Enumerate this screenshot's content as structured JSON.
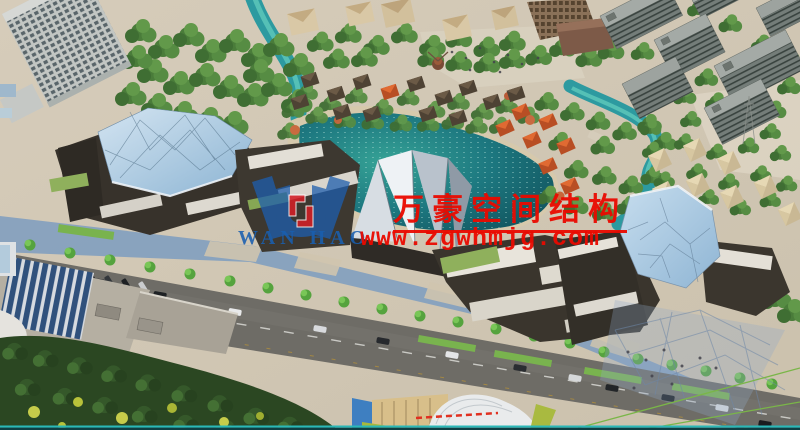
{
  "watermark": {
    "logo_text": "WAN HAO",
    "company_name_cn": "万豪空间结构",
    "website_url": "www.zgwhmjg.com",
    "brand_blue": "#1e5fae",
    "brand_red": "#ea0a00"
  },
  "scene": {
    "palette": {
      "lake_teal": "#1d7880",
      "stream_teal": "#2d9aa0",
      "tree_green": "#4a7c3a",
      "dark_forest": "#2b4722",
      "glass_blue": "#aecde4",
      "building_dark": "#37322b",
      "roof_white": "#e8e4db",
      "roof_green": "#8fb05c",
      "roof_orange": "#c8552a",
      "road_gray": "#6e6c66",
      "promenade_blue": "#7d9cc0",
      "pavement_tan": "#cfc5b2"
    }
  }
}
